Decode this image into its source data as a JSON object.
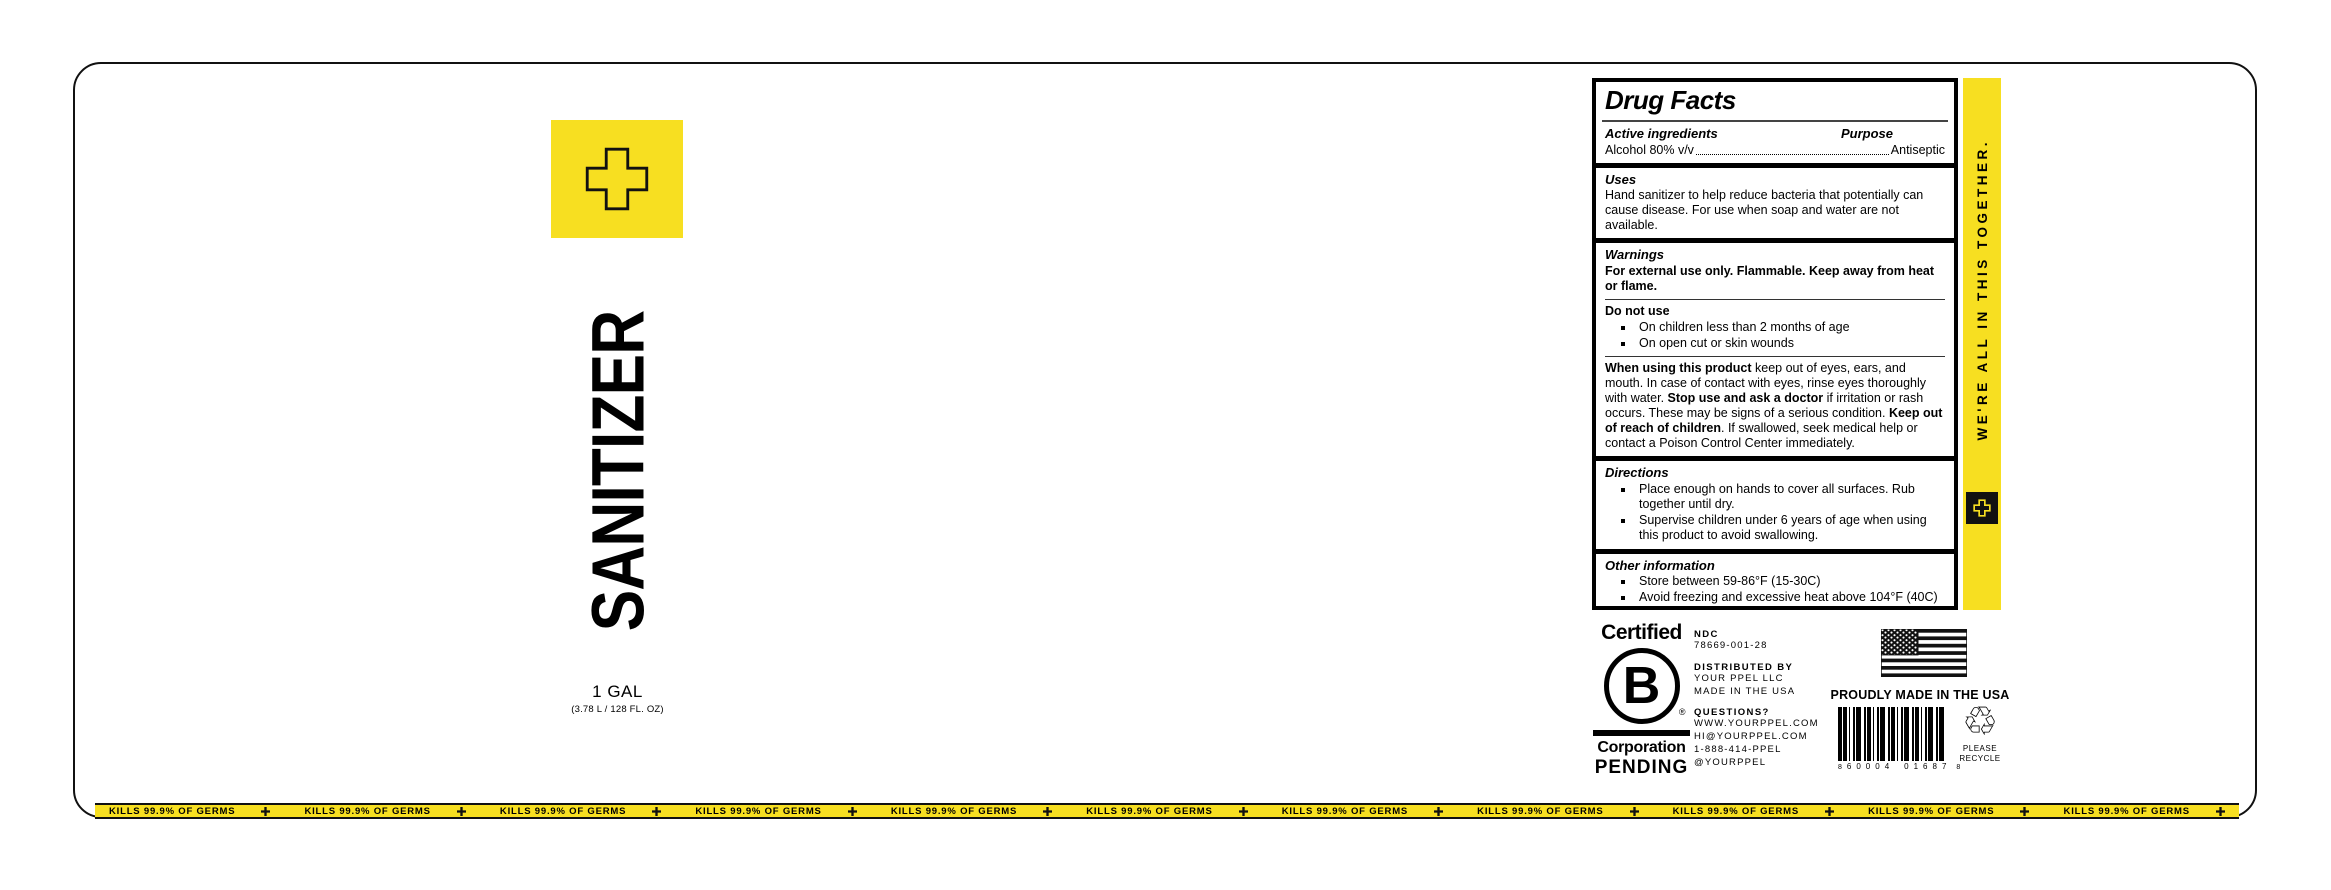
{
  "colors": {
    "yellow": "#F7DF21",
    "black": "#111111"
  },
  "brand": {
    "product_name": "SANITIZER",
    "size": "1 GAL",
    "size_detail": "(3.78 L / 128 FL. OZ)"
  },
  "drug_facts": {
    "title": "Drug Facts",
    "active": {
      "heading": "Active ingredients",
      "purpose_heading": "Purpose",
      "ingredient": "Alcohol 80% v/v",
      "purpose": "Antiseptic"
    },
    "uses": {
      "heading": "Uses",
      "text": "Hand sanitizer to help reduce bacteria that potentially can cause disease. For use when soap and water are not available."
    },
    "warnings": {
      "heading": "Warnings",
      "text": "For external use only. Flammable. Keep away from heat or flame.",
      "do_not_use": {
        "heading": "Do not use",
        "items": [
          "On children less than 2 months of age",
          "On open cut or skin wounds"
        ]
      },
      "when_using": {
        "segments": [
          {
            "text": "When using this product",
            "bold": true
          },
          {
            "text": " keep out of eyes, ears, and mouth. In case of contact with eyes, rinse eyes thoroughly with water. ",
            "bold": false
          },
          {
            "text": "Stop use and ask a doctor",
            "bold": true
          },
          {
            "text": " if irritation or rash occurs. These may be signs of a serious condition. ",
            "bold": false
          },
          {
            "text": "Keep out of reach of children",
            "bold": true
          },
          {
            "text": ". If swallowed, seek medical help or contact a Poison Control Center immediately.",
            "bold": false
          }
        ]
      }
    },
    "directions": {
      "heading": "Directions",
      "items": [
        "Place enough on hands to cover all surfaces. Rub together until dry.",
        "Supervise children under 6 years of age when using this product to avoid swallowing."
      ]
    },
    "other_information": {
      "heading": "Other information",
      "items": [
        "Store between 59-86°F (15-30C)",
        "Avoid freezing and excessive heat above 104°F (40C)"
      ]
    },
    "inactive": {
      "heading": "Inactive ingredients",
      "text": "glycerin, hydrogen peroxide, purified water USP"
    }
  },
  "side_strip": {
    "text": "WE'RE ALL IN THIS TOGETHER."
  },
  "certification": {
    "certified": "Certified",
    "b": "B",
    "registered": "®",
    "corporation": "Corporation",
    "pending": "PENDING"
  },
  "distribution": {
    "ndc_label": "NDC",
    "ndc_value": "78669-001-28",
    "distributed_label": "DISTRIBUTED BY",
    "distributed_lines": [
      "YOUR PPEL LLC",
      "MADE IN THE USA"
    ],
    "questions_label": "QUESTIONS?",
    "questions_lines": [
      "WWW.YOURPPEL.COM",
      "HI@YOURPPEL.COM",
      "1-888-414-PPEL",
      "@YOURPPEL"
    ]
  },
  "origin": {
    "proudly": "PROUDLY MADE IN THE USA"
  },
  "barcode": {
    "left_digit": "8",
    "group1": "60004",
    "group2": "01687",
    "right_digit": "8"
  },
  "recycle": {
    "symbol": "♲",
    "text_line1": "PLEASE",
    "text_line2": "RECYCLE"
  },
  "germs_band": {
    "text": "KILLS 99.9% OF GERMS",
    "repeat": 11
  }
}
